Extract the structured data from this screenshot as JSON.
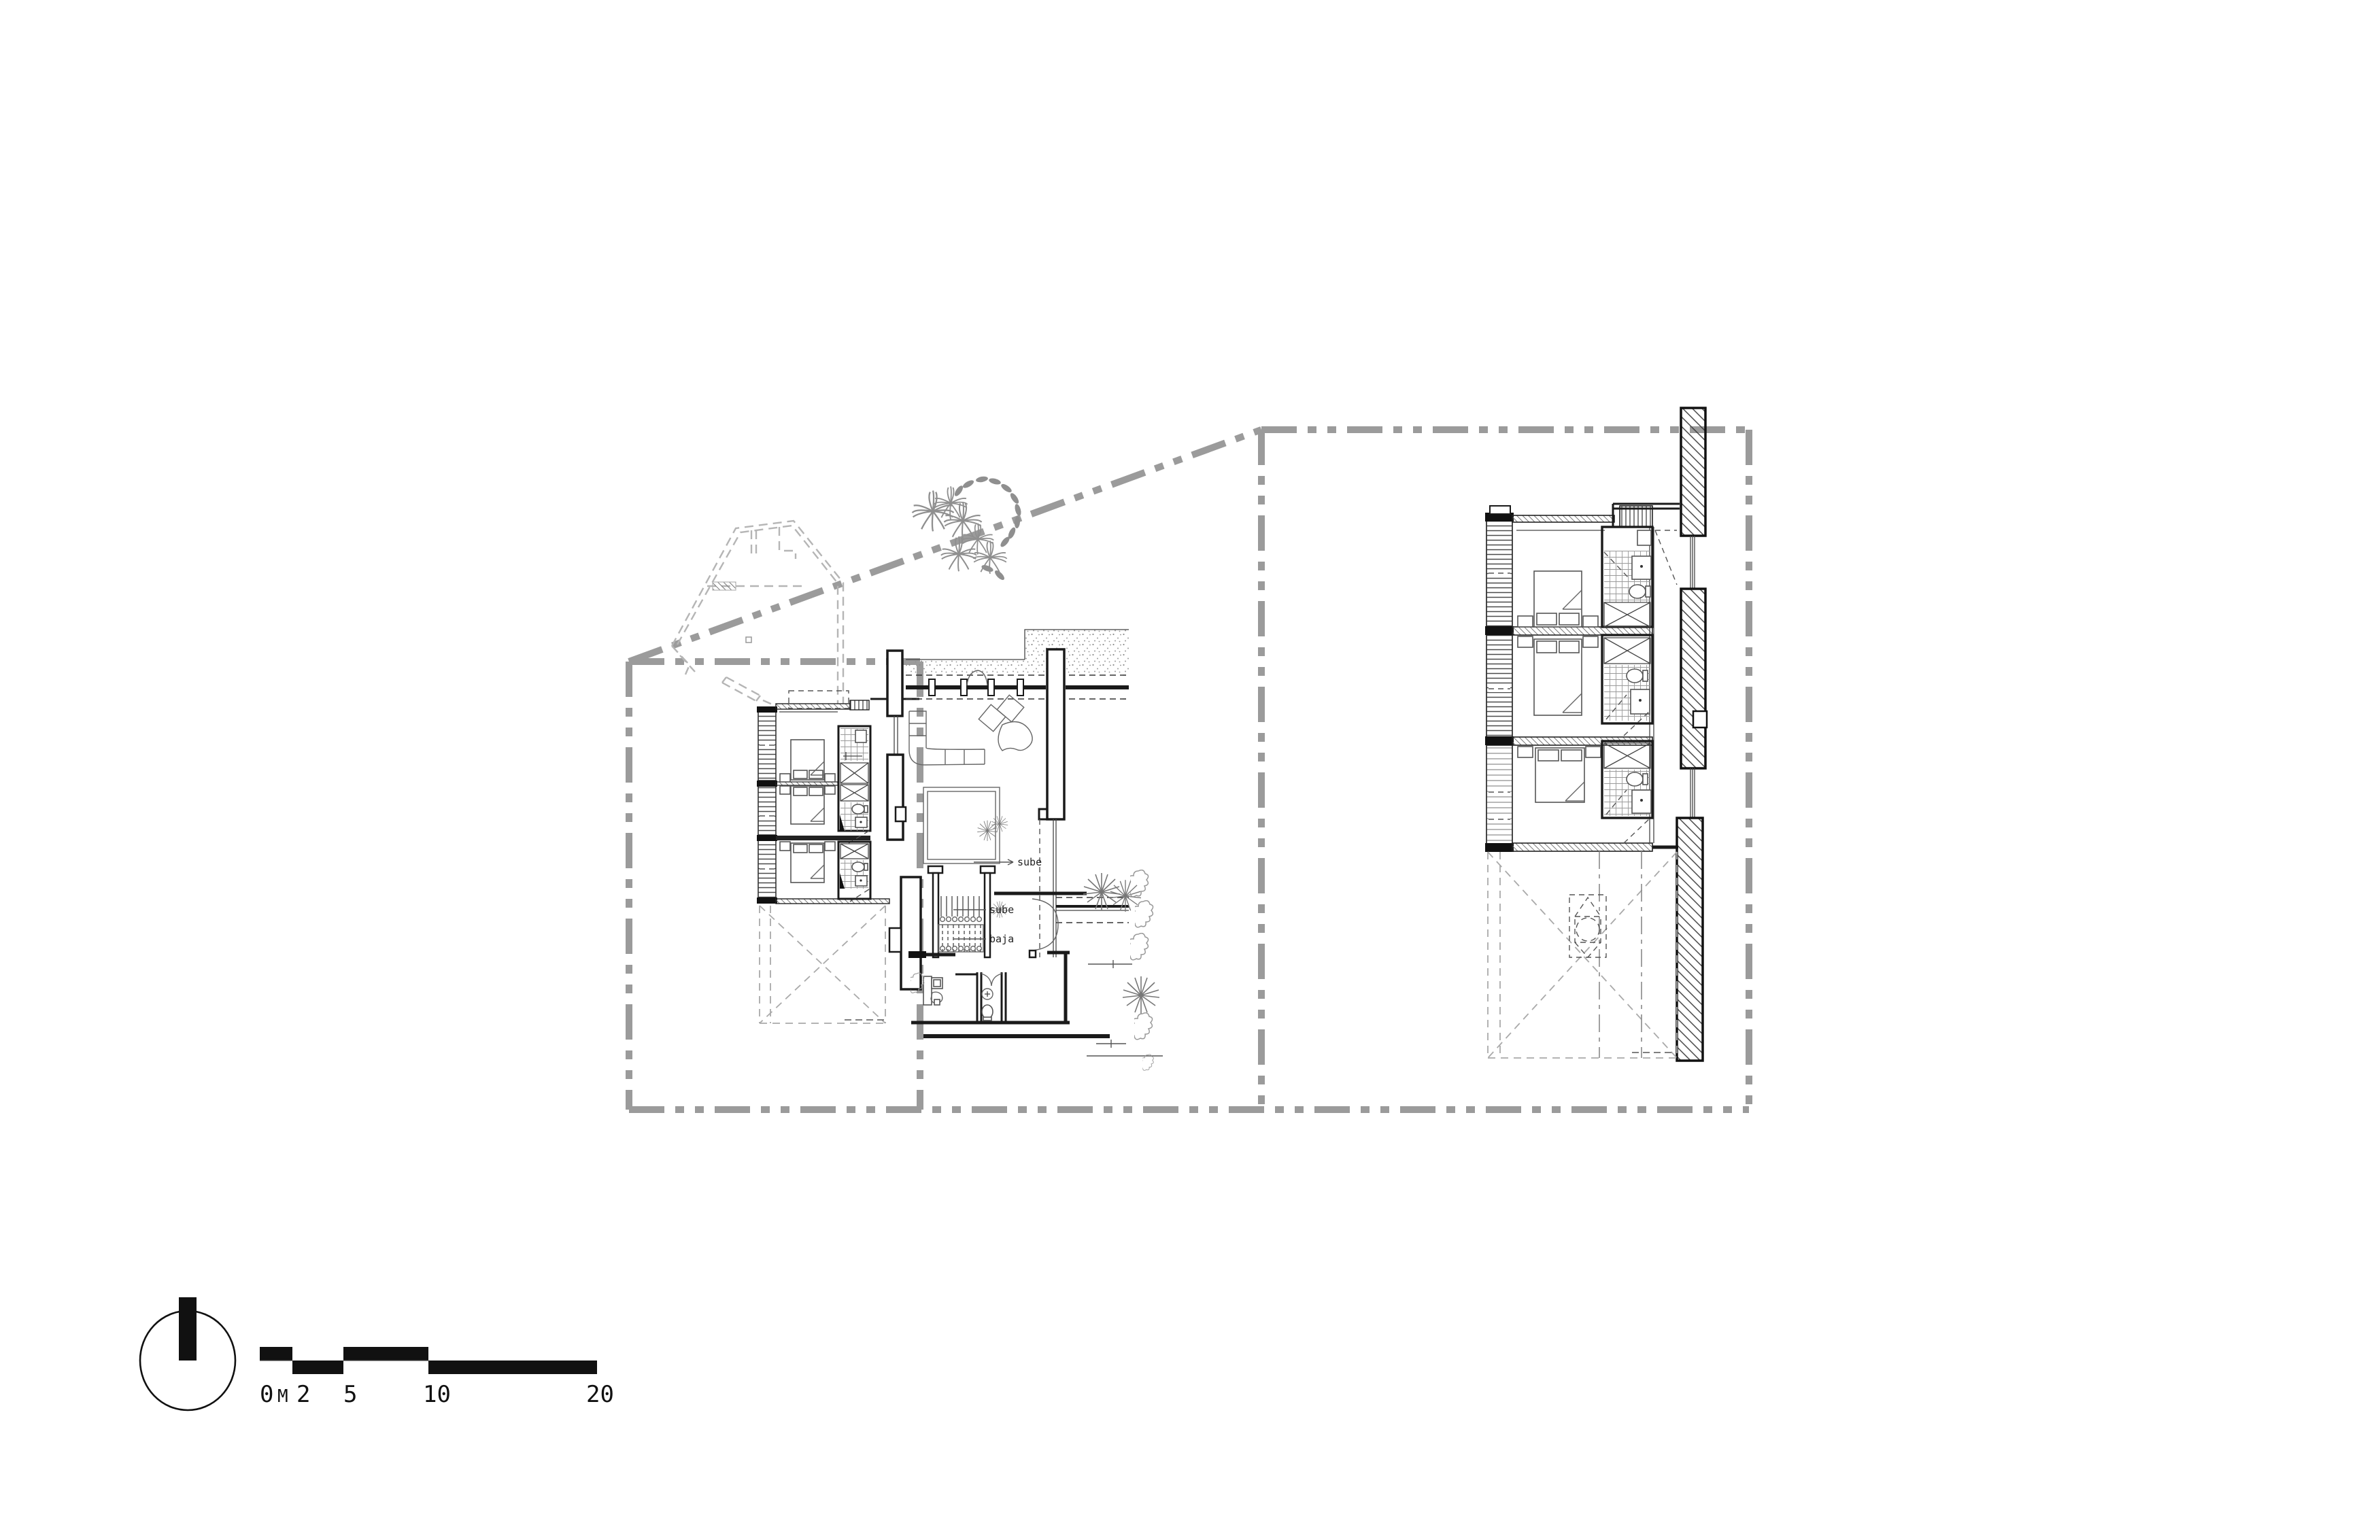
{
  "document": {
    "kind": "architectural-floor-plan",
    "sheet_background": "#ffffff",
    "views": [
      {
        "id": "site-plan",
        "role": "ground-floor site plan with callout box"
      },
      {
        "id": "detail-plan",
        "role": "enlarged bedroom-wing plan inside callout box"
      }
    ]
  },
  "annotations": {
    "ramp_up_label": "sube",
    "stair_up_label": "sube",
    "stair_down_label": "baja"
  },
  "scalebar": {
    "unit": "M",
    "t0": "0",
    "t2": "2",
    "t5": "5",
    "t10": "10",
    "t20": "20",
    "segments_m": [
      [
        0,
        2
      ],
      [
        2,
        5
      ],
      [
        5,
        10
      ],
      [
        10,
        20
      ]
    ]
  },
  "north_arrow": {
    "present": true,
    "direction": "up"
  },
  "colors": {
    "ink": "#1a1a1a",
    "callout_boundary": "#9b9b9b",
    "roof_outline": "#b5b5b5",
    "vegetation": "#8f8f8f",
    "tile_hatch": "#9a9a9a",
    "paper": "#ffffff"
  }
}
